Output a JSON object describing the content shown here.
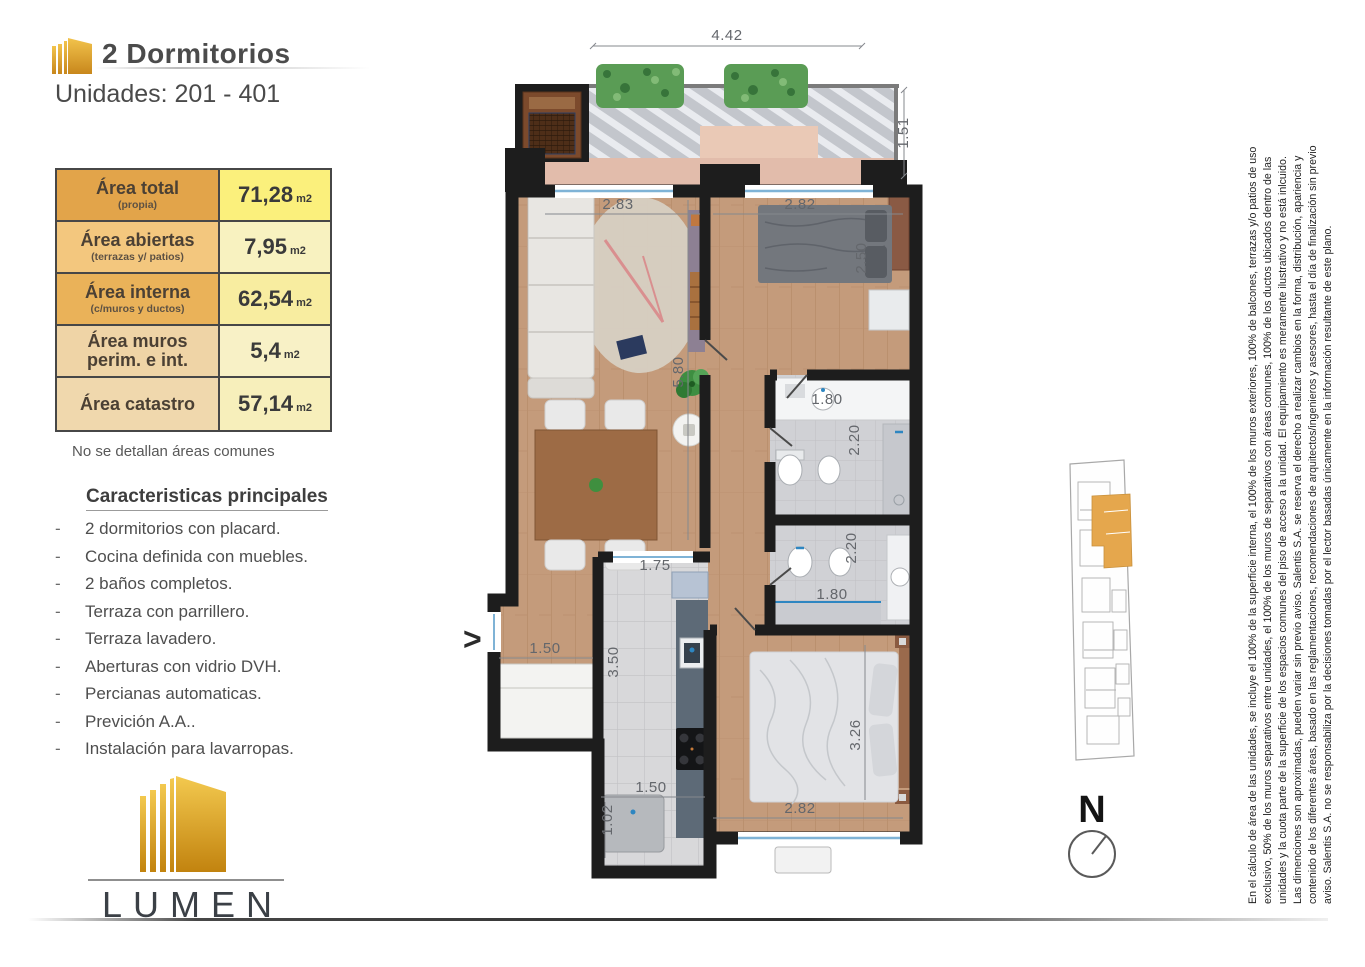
{
  "header": {
    "title": "2 Dormitorios",
    "subtitle": "Unidades: 201 - 401"
  },
  "area_table": {
    "rows": [
      {
        "label": "Área total",
        "sublabel": "(propia)",
        "value": "71,28",
        "unit": "m2"
      },
      {
        "label": "Área abiertas",
        "sublabel": "(terrazas y/ patios)",
        "value": "7,95",
        "unit": "m2"
      },
      {
        "label": "Área interna",
        "sublabel": "(c/muros y ductos)",
        "value": "62,54",
        "unit": "m2"
      },
      {
        "label": "Área muros perim. e int.",
        "sublabel": "",
        "value": "5,4",
        "unit": "m2"
      },
      {
        "label": "Área catastro",
        "sublabel": "",
        "value": "57,14",
        "unit": "m2"
      }
    ]
  },
  "note": "No se detallan áreas comunes",
  "features": {
    "heading": "Caracteristicas principales",
    "items": [
      "2 dormitorios con placard.",
      "Cocina definida con muebles.",
      "2 baños completos.",
      "Terraza con parrillero.",
      "Terraza lavadero.",
      "Aberturas con vidrio DVH.",
      "Percianas automaticas.",
      "Previción A.A..",
      "Instalación para lavarropas."
    ]
  },
  "logo": {
    "brand": "LUMEN"
  },
  "floor_plan": {
    "entry_marker": ">",
    "dims": [
      "4.42",
      "1.51",
      "2.83",
      "2.82",
      "2.50",
      "5.80",
      "1.80",
      "2.20",
      "2.20",
      "1.80",
      "1.75",
      "3.50",
      "1.50",
      "1.50",
      "1.02",
      "2.82",
      "3.26"
    ]
  },
  "compass": {
    "label": "N"
  },
  "disclaimer": {
    "lines": [
      "En el cálculo de área de las unidades, se incluye el 100% de la superficie interna, el 100% de los muros exteriores, 100% de balcones, terrazas y/o patios de uso",
      "exclusivo, 50% de los muros separativos entre unidades, el 100% de los muros de separativos con áreas comunes, 100% de los ductos ubicados dentro de las",
      "unidades y la cuota parte de la superficie de los espacios comunes del piso de acceso a la unidad. El equipamiento es meramente ilustrativo y no está inlcuido.",
      "Las dimenciones son aproximadas, pueden variar sin previo aviso. Salentis S.A. se reserva el derecho a realizar cambios en la forma, distribución, apariencia y",
      "contenido de los diferentes áreas, basado en las reglamentaciones, recomendaciones de arquitectos/ingenieros y asesores, hasta el día de finalización sin previo",
      "aviso. Salentis S.A. no se responsabiliza por la decisiones tomadas por el lector basadas únicamente en la información resultante de este plano."
    ]
  },
  "colors": {
    "accent_gold": "#d99b2b",
    "unit_highlight": "#e5a74d",
    "wall": "#1d1d1d",
    "wood_floor": "#c49b7b",
    "hedge_green": "#5a9c55",
    "water_blue": "#7fb3d6",
    "table_row1_label_bg": "#e2a44a",
    "table_row1_value_bg": "#fbf07c"
  }
}
